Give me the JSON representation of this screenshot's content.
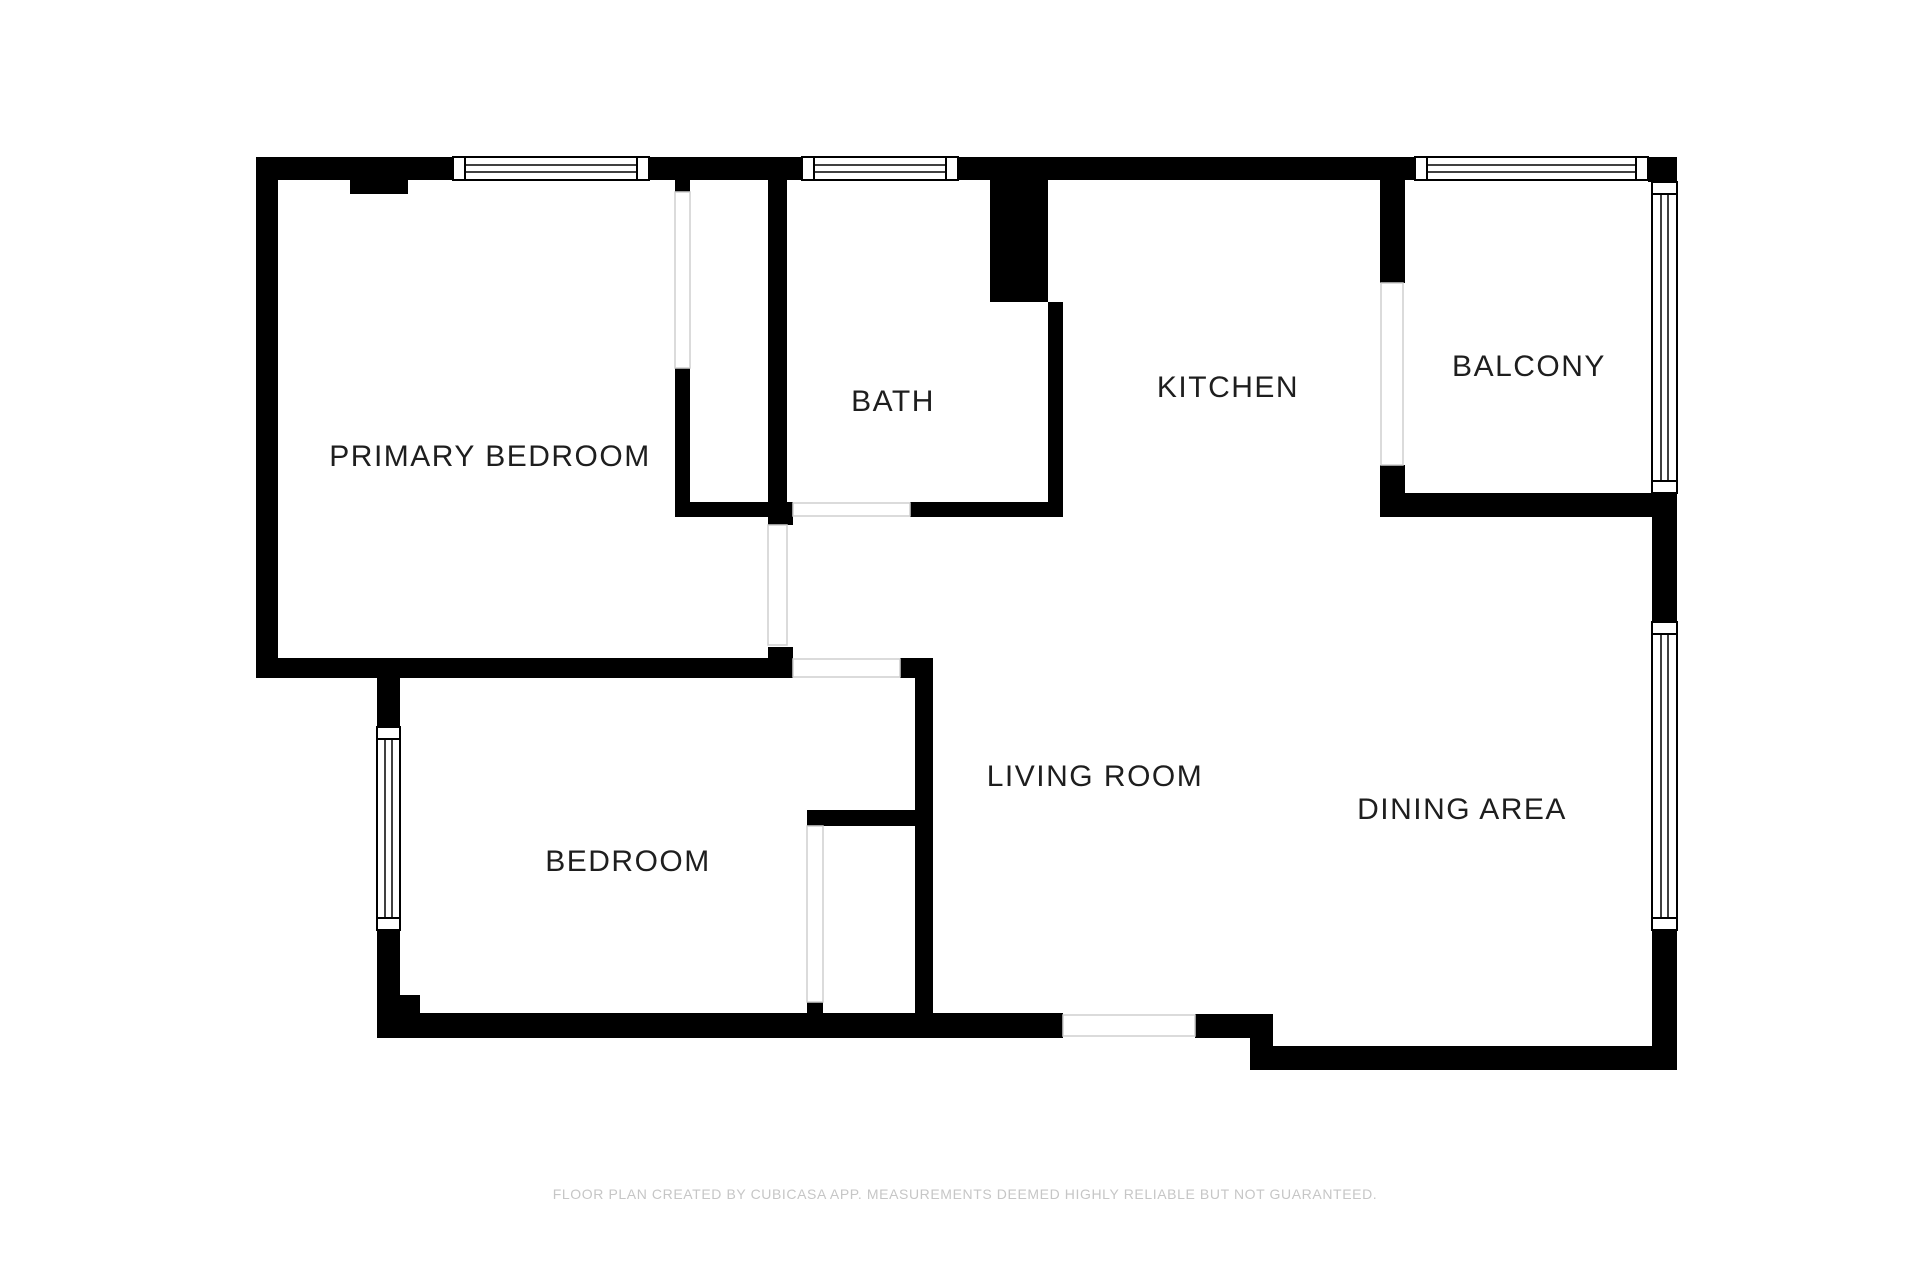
{
  "page": {
    "width": 1920,
    "height": 1280,
    "background": "#ffffff"
  },
  "colors": {
    "wall": "#000000",
    "room_fill": "#ffffff",
    "opening_line": "#cfcfcf",
    "label_text": "#1e1e1e",
    "footer_text": "#c6c6c6"
  },
  "rooms": [
    {
      "id": "primary-bedroom",
      "label": "PRIMARY BEDROOM",
      "cx": 490,
      "cy": 457
    },
    {
      "id": "bath",
      "label": "BATH",
      "cx": 893,
      "cy": 402
    },
    {
      "id": "kitchen",
      "label": "KITCHEN",
      "cx": 1228,
      "cy": 388
    },
    {
      "id": "balcony",
      "label": "BALCONY",
      "cx": 1529,
      "cy": 367
    },
    {
      "id": "bedroom",
      "label": "BEDROOM",
      "cx": 628,
      "cy": 862
    },
    {
      "id": "living-room",
      "label": "LIVING ROOM",
      "cx": 1095,
      "cy": 777
    },
    {
      "id": "dining-area",
      "label": "DINING AREA",
      "cx": 1462,
      "cy": 810
    }
  ],
  "footer": {
    "text": "FLOOR PLAN CREATED BY CUBICASA APP. MEASUREMENTS DEEMED HIGHLY RELIABLE BUT NOT GUARANTEED.",
    "cx": 965,
    "cy": 1194
  },
  "plan": {
    "walls": [
      [
        256,
        157,
        197,
        23
      ],
      [
        649,
        157,
        153,
        23
      ],
      [
        958,
        157,
        457,
        23
      ],
      [
        1648,
        157,
        29,
        25
      ],
      [
        256,
        157,
        22,
        521
      ],
      [
        256,
        658,
        537,
        20
      ],
      [
        768,
        647,
        25,
        11
      ],
      [
        350,
        180,
        58,
        14
      ],
      [
        675,
        180,
        15,
        12
      ],
      [
        675,
        368,
        15,
        149
      ],
      [
        675,
        502,
        93,
        15
      ],
      [
        768,
        180,
        19,
        345
      ],
      [
        768,
        502,
        25,
        23
      ],
      [
        910,
        502,
        153,
        15
      ],
      [
        990,
        180,
        58,
        122
      ],
      [
        1048,
        302,
        15,
        215
      ],
      [
        1380,
        180,
        25,
        103
      ],
      [
        1380,
        465,
        25,
        52
      ],
      [
        1380,
        493,
        272,
        24
      ],
      [
        1652,
        493,
        25,
        129
      ],
      [
        1652,
        930,
        25,
        140
      ],
      [
        1250,
        1046,
        427,
        24
      ],
      [
        1195,
        1014,
        78,
        24
      ],
      [
        1250,
        1038,
        23,
        9
      ],
      [
        377,
        1013,
        686,
        25
      ],
      [
        377,
        678,
        23,
        49
      ],
      [
        377,
        930,
        23,
        83
      ],
      [
        400,
        995,
        20,
        18
      ],
      [
        807,
        810,
        126,
        16
      ],
      [
        807,
        1002,
        16,
        11
      ],
      [
        915,
        658,
        18,
        355
      ],
      [
        900,
        658,
        33,
        20
      ]
    ],
    "windows": [
      {
        "x": 453,
        "y": 157,
        "w": 196,
        "h": 23,
        "o": "h"
      },
      {
        "x": 802,
        "y": 157,
        "w": 156,
        "h": 23,
        "o": "h"
      },
      {
        "x": 1415,
        "y": 157,
        "w": 233,
        "h": 23,
        "o": "h"
      },
      {
        "x": 1652,
        "y": 182,
        "w": 25,
        "h": 311,
        "o": "v"
      },
      {
        "x": 1652,
        "y": 622,
        "w": 25,
        "h": 308,
        "o": "v"
      },
      {
        "x": 377,
        "y": 727,
        "w": 23,
        "h": 203,
        "o": "v"
      }
    ],
    "openings": [
      {
        "x": 675,
        "y": 192,
        "w": 15,
        "h": 176
      },
      {
        "x": 768,
        "y": 525,
        "w": 19,
        "h": 120
      },
      {
        "x": 807,
        "y": 826,
        "w": 16,
        "h": 176
      },
      {
        "x": 793,
        "y": 503,
        "w": 117,
        "h": 13
      },
      {
        "x": 793,
        "y": 659,
        "w": 107,
        "h": 18
      },
      {
        "x": 1381,
        "y": 283,
        "w": 22,
        "h": 182
      },
      {
        "x": 1063,
        "y": 1015,
        "w": 132,
        "h": 21
      }
    ]
  }
}
